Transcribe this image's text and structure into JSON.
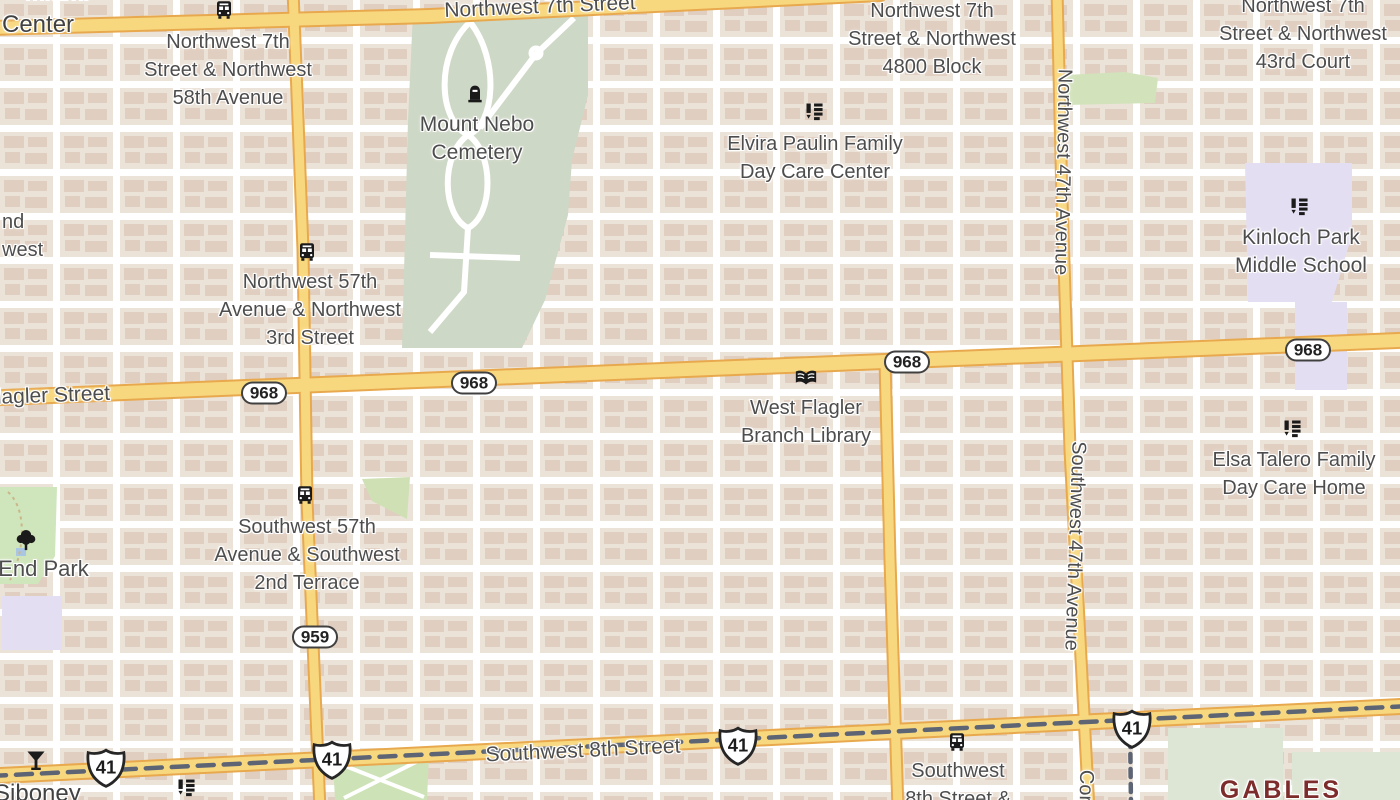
{
  "map": {
    "city_labels": {
      "miami_partial": "Miami",
      "siboney": "Siboney",
      "gables_partial": "GABLES"
    },
    "street_labels": {
      "nw7": "Northwest 7th Street",
      "flagler_partial": "Flagler Street",
      "sw8": "Southwest 8th Street",
      "nw47": "Northwest 47th Avenue",
      "sw47": "Southwest 47th Avenue",
      "cor_partial": "Cor",
      "center_partial": "l Center",
      "nd_partial": "nd",
      "west_partial": "west"
    },
    "poi_labels": {
      "nw7_58": {
        "l1": "Northwest 7th",
        "l2": "Street & Northwest",
        "l3": "58th Avenue"
      },
      "nw7_4800": {
        "l1": "Northwest 7th",
        "l2": "Street & Northwest",
        "l3": "4800 Block"
      },
      "nw7_43": {
        "l1": "Northwest 7th",
        "l2": "Street & Northwest",
        "l3": "43rd Court"
      },
      "mount_nebo": {
        "l1": "Mount Nebo",
        "l2": "Cemetery"
      },
      "elvira": {
        "l1": "Elvira Paulin Family",
        "l2": "Day Care Center"
      },
      "kinloch": {
        "l1": "Kinloch Park",
        "l2": "Middle School"
      },
      "nw57_3rd": {
        "l1": "Northwest 57th",
        "l2": "Avenue & Northwest",
        "l3": "3rd Street"
      },
      "library": {
        "l1": "West Flagler",
        "l2": "Branch Library"
      },
      "elsa": {
        "l1": "Elsa Talero Family",
        "l2": "Day Care Home"
      },
      "sw57_2nd": {
        "l1": "Southwest 57th",
        "l2": "Avenue & Southwest",
        "l3": "2nd Terrace"
      },
      "west_end_park_partial": "t End Park",
      "sw8_stop": {
        "l1": "Southwest",
        "l2": "8th Street &"
      }
    },
    "shields": {
      "route_968": "968",
      "route_959": "959",
      "route_41": "41"
    },
    "icons": {
      "bus": "bus-stop-icon",
      "school": "school-icon",
      "cemetery": "cemetery-icon",
      "library": "library-book-icon",
      "bar": "cocktail-icon",
      "park": "tree-icon"
    },
    "colors": {
      "land": "#f0eae1",
      "block": "#ece3d8",
      "building": "#e0cec0",
      "road_major": "#f8d87f",
      "road_casing": "#e8a94e",
      "road_minor": "#ffffff",
      "park_green": "#cfe5bb",
      "cemetery_green": "#ced8c6",
      "school_lavender": "#e4def2",
      "label_gray": "#4d4d4d",
      "city_maroon": "#7d2c2c",
      "transit_line": "#5d6575",
      "icon_black": "#1a1a1a"
    }
  }
}
